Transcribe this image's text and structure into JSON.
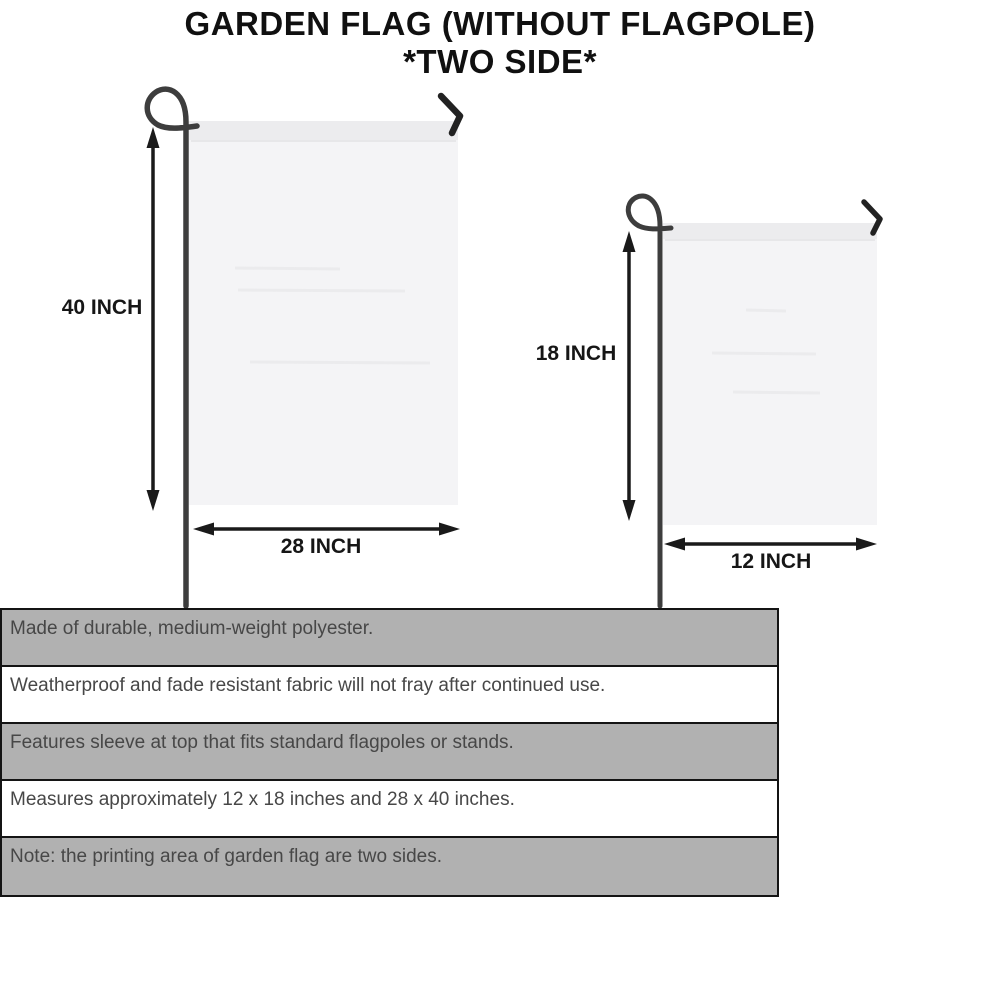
{
  "title": {
    "line1": "GARDEN FLAG (WITHOUT FLAGPOLE)",
    "line2": "*TWO SIDE*"
  },
  "diagram": {
    "large_flag": {
      "height_label": "40 INCH",
      "width_label": "28 INCH"
    },
    "small_flag": {
      "height_label": "18 INCH",
      "width_label": "12 INCH"
    }
  },
  "features": {
    "rows": [
      {
        "text": "Made of durable, medium-weight polyester."
      },
      {
        "text": "Weatherproof and fade resistant fabric will not fray after continued use."
      },
      {
        "text": "Features sleeve at top that fits standard flagpoles or stands."
      },
      {
        "text": "Measures approximately 12 x 18 inches and 28 x 40 inches."
      },
      {
        "text": "Note: the printing area of garden flag are two sides."
      }
    ]
  },
  "colors": {
    "background": "#ffffff",
    "flag_fill": "#f4f4f6",
    "flag_sleeve": "#ececee",
    "pole": "#3d3d3d",
    "arrow": "#1a1a1a",
    "table_shaded_row": "#b1b1b1",
    "table_border": "#141414",
    "table_text": "#474747",
    "title_text": "#101010"
  }
}
